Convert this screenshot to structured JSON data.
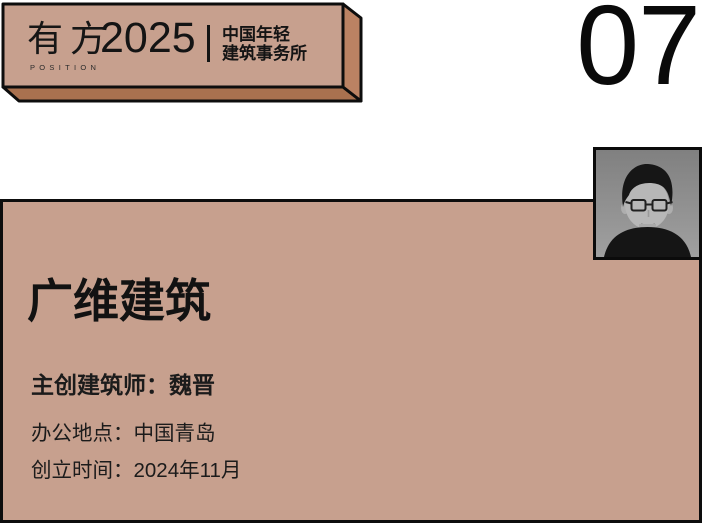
{
  "banner": {
    "logo_cn": "有方",
    "logo_en": "POSITION",
    "year": "2025",
    "subtitle_line1": "中国年轻",
    "subtitle_line2": "建筑事务所"
  },
  "page_number": "07",
  "portrait": {
    "description": "grayscale headshot of architect with glasses and dark shirt"
  },
  "card": {
    "studio_name": "广维建筑",
    "architect": {
      "label": "主创建筑师：",
      "value": "魏晋"
    },
    "location": {
      "label": "办公地点：",
      "value": "中国青岛"
    },
    "founded": {
      "label": "创立时间：",
      "value": "2024年11月"
    }
  },
  "colors": {
    "banner_face": "#c7a08e",
    "banner_side_right": "#bb8263",
    "banner_side_bottom": "#a9714f",
    "card_background": "#c7a08e",
    "outline": "#0d0d0d",
    "text": "#141414",
    "photo_background": "#8c8c8c"
  }
}
